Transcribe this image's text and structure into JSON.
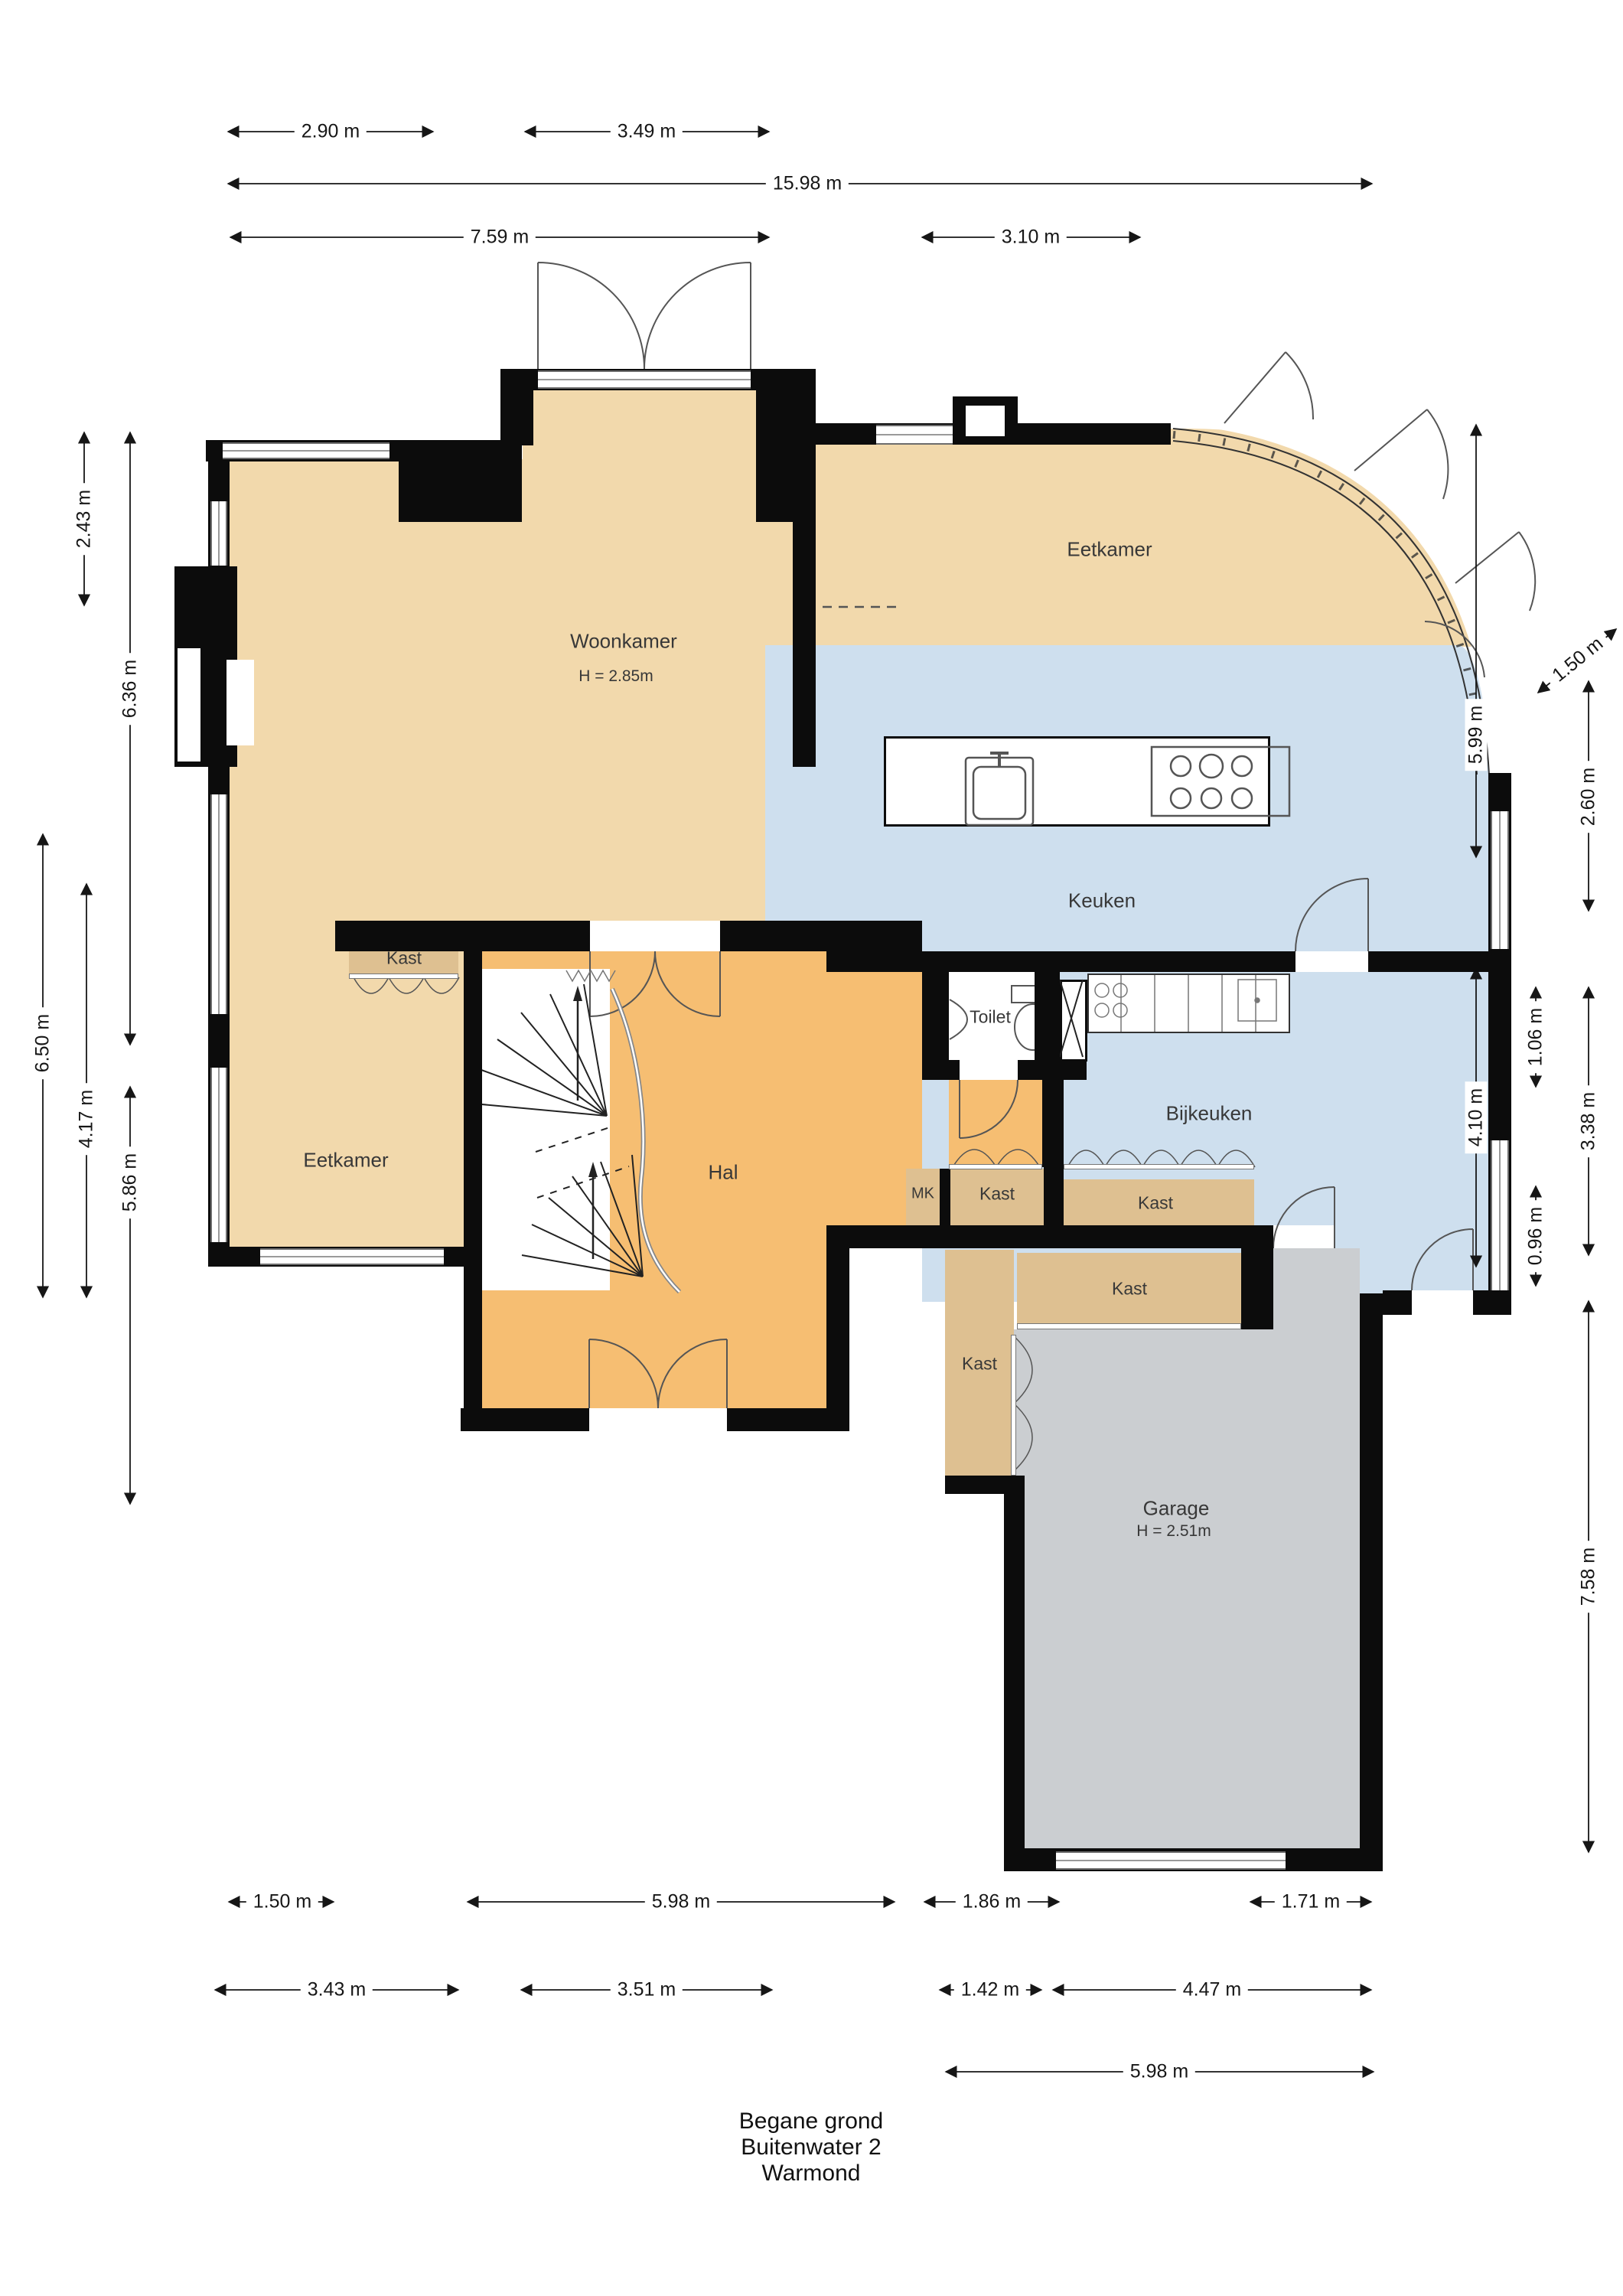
{
  "title": {
    "line1": "Begane grond",
    "line2": "Buitenwater 2",
    "line3": "Warmond"
  },
  "rooms": {
    "woonkamer": {
      "name": "Woonkamer",
      "height_note": "H = 2.85m"
    },
    "eetkamer_top": {
      "name": "Eetkamer"
    },
    "eetkamer_left": {
      "name": "Eetkamer"
    },
    "keuken": {
      "name": "Keuken"
    },
    "bijkeuken": {
      "name": "Bijkeuken"
    },
    "hal": {
      "name": "Hal"
    },
    "toilet": {
      "name": "Toilet"
    },
    "mk": {
      "name": "MK"
    },
    "garage": {
      "name": "Garage",
      "height_note": "H = 2.51m"
    }
  },
  "closets": [
    {
      "label": "Kast"
    },
    {
      "label": "Kast"
    },
    {
      "label": "Kast"
    },
    {
      "label": "Kast"
    },
    {
      "label": "Kast"
    }
  ],
  "dimensions": {
    "top": [
      {
        "label": "2.90 m"
      },
      {
        "label": "3.49 m"
      },
      {
        "label": "15.98 m"
      },
      {
        "label": "7.59 m"
      },
      {
        "label": "3.10 m"
      }
    ],
    "left": [
      {
        "label": "2.43 m"
      },
      {
        "label": "6.36 m"
      },
      {
        "label": "6.50 m"
      },
      {
        "label": "4.17 m"
      },
      {
        "label": "5.86 m"
      }
    ],
    "right": [
      {
        "label": "1.50 m"
      },
      {
        "label": "5.99 m"
      },
      {
        "label": "2.60 m"
      },
      {
        "label": "1.06 m"
      },
      {
        "label": "4.10 m"
      },
      {
        "label": "3.38 m"
      },
      {
        "label": "0.96 m"
      },
      {
        "label": "7.58 m"
      }
    ],
    "bottom": [
      {
        "label": "1.50 m"
      },
      {
        "label": "5.98 m"
      },
      {
        "label": "1.86 m"
      },
      {
        "label": "1.71 m"
      },
      {
        "label": "3.43 m"
      },
      {
        "label": "3.51 m"
      },
      {
        "label": "1.42 m"
      },
      {
        "label": "4.47 m"
      },
      {
        "label": "5.98 m"
      }
    ]
  },
  "colors": {
    "living_tan": "#F2D9AC",
    "closet_tan": "#DEC091",
    "hall_orange": "#F6BE72",
    "kitchen_blue": "#CEDFEE",
    "garage_gray": "#CBCED1",
    "wall_black": "#0C0C0C"
  }
}
